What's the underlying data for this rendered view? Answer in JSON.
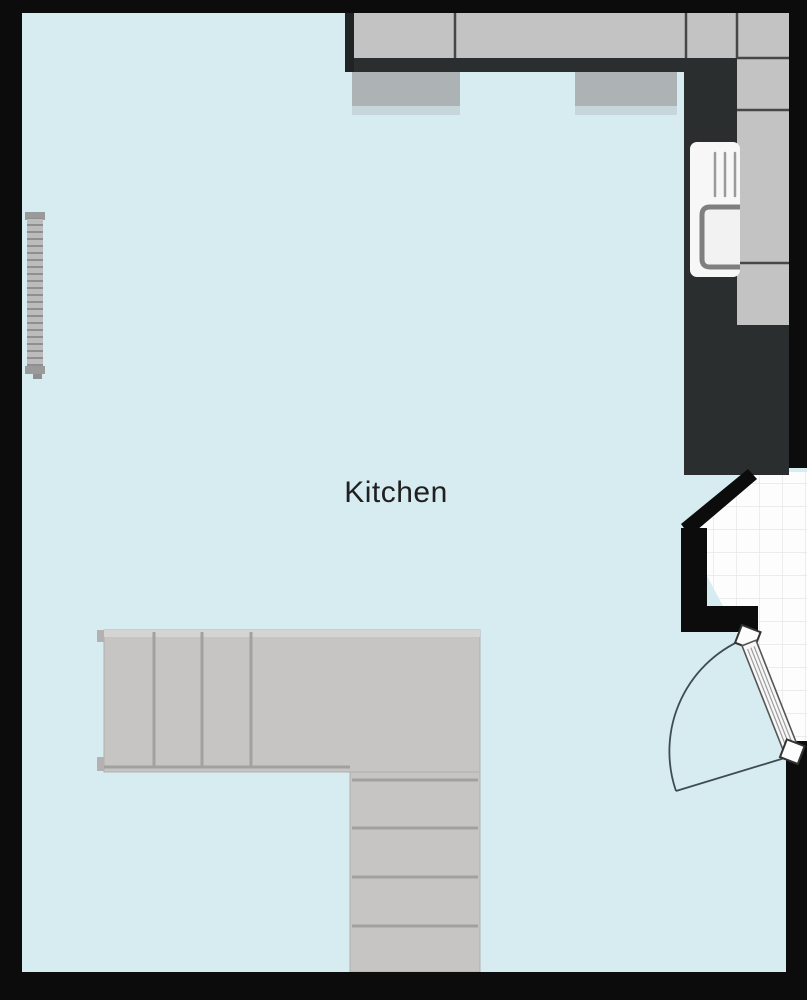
{
  "room": {
    "label": "Kitchen"
  },
  "fixtures": [
    "top-counter-run",
    "right-counter-run",
    "worktop-edge",
    "tall-unit",
    "wall-cabinet-left",
    "wall-cabinet-right",
    "sink-unit",
    "radiator",
    "l-shaped-staircase",
    "door-with-swing-arc",
    "adjacent-tiled-floor"
  ],
  "colors": {
    "floor": "#d6ecf1",
    "wall": "#0c0c0c",
    "counter": "#c3c3c3",
    "charcoal": "#2b2e2e",
    "cabinet": "#a9aeb0",
    "stair": "#c7c5c3",
    "stairline": "#a3a19f",
    "tile": "#fdfdfd",
    "tileline": "#e3e3e3",
    "arc": "#3d4c52",
    "ink": "#202020",
    "divider": "#474747"
  }
}
